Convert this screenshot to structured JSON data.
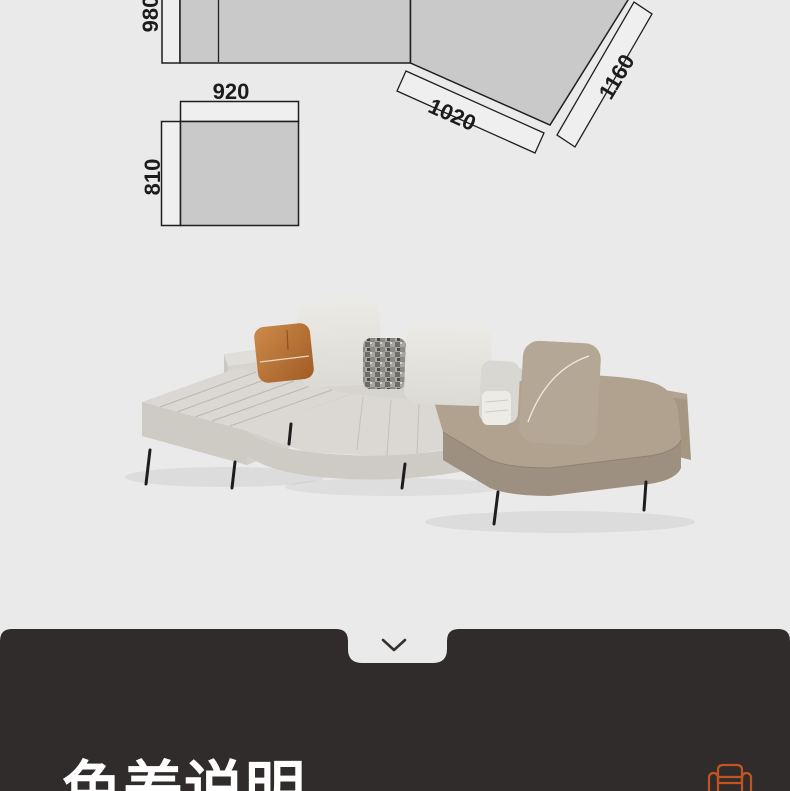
{
  "page": {
    "background_color": "#eaeaea"
  },
  "spec_diagram": {
    "dimensions": {
      "sofa_depth": "980",
      "ottoman_width": "920",
      "ottoman_depth": "810",
      "angled_seat_length": "1020",
      "angled_back_length": "1160"
    },
    "colors": {
      "fill_gray": "#c9c9c9",
      "band_fill": "#efefef",
      "line": "#1f1f1f"
    }
  },
  "product_photo": {
    "colors": {
      "leather_light": "#dbd8d3",
      "leather_light_front": "#cecbc5",
      "leather_taupe": "#b1a290",
      "leather_taupe_front": "#9e9080",
      "back_block_taupe": "#a59682",
      "pillow_offwhite": "#e7e5e0",
      "pillow_taupe": "#b5a795",
      "pillow_small_gray": "#d9d7d1",
      "pillow_lumbar_white": "#edebe5",
      "legs": "#1d1d1d"
    }
  },
  "detail_panel": {
    "background_color": "#302c2b",
    "chevron_icon": "chevron-down",
    "heading": "色差说明",
    "heading_color": "#ffffff",
    "sofa_icon": "sofa-outline",
    "sofa_icon_color": "#c3541f"
  }
}
